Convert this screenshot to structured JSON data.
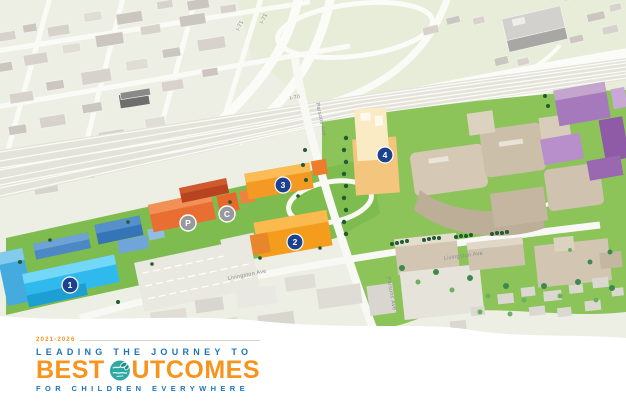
{
  "map": {
    "description": "Isometric aerial illustration of hospital campus and surrounding city",
    "highway_labels": [
      {
        "id": "i71-west",
        "text": "I-71"
      },
      {
        "id": "i71-east",
        "text": "I-71"
      },
      {
        "id": "i70",
        "text": "I-70"
      }
    ],
    "street_labels": [
      {
        "id": "parsons-north",
        "text": "Parsons Ave"
      },
      {
        "id": "parsons-south",
        "text": "Parsons Ave"
      },
      {
        "id": "livingston-west",
        "text": "Livingston Ave"
      },
      {
        "id": "livingston-east",
        "text": "Livingston Ave"
      }
    ],
    "markers": [
      {
        "id": "1",
        "label": "1",
        "color": "#1B418F"
      },
      {
        "id": "2",
        "label": "2",
        "color": "#1B418F"
      },
      {
        "id": "3",
        "label": "3",
        "color": "#1B418F"
      },
      {
        "id": "4",
        "label": "4",
        "color": "#1B418F"
      },
      {
        "id": "P",
        "label": "P",
        "color": "#97999E"
      },
      {
        "id": "C",
        "label": "C",
        "color": "#97999E"
      }
    ],
    "colors": {
      "campus_lawn": "#7FBC4F",
      "park": "#8CC45A",
      "blue_buildings": "#3674B8",
      "cyan_building": "#2FB9EC",
      "orange_buildings": "#E86F31",
      "yellow_buildings": "#F49C1C",
      "tan_hospital": "#C9BCA7",
      "purple_buildings": "#A678BC",
      "marker_navy": "#1B418F",
      "marker_gray": "#97999E"
    }
  },
  "logo": {
    "years": "2021-2026",
    "line1": "LEADING THE JOURNEY TO",
    "brand_best": "BEST",
    "brand_outcomes_rest": "UTCOMES",
    "line2": "FOR CHILDREN EVERYWHERE",
    "colors": {
      "blue": "#1B75BC",
      "orange": "#F7941D",
      "globe_teal": "#2FA8A4"
    }
  }
}
